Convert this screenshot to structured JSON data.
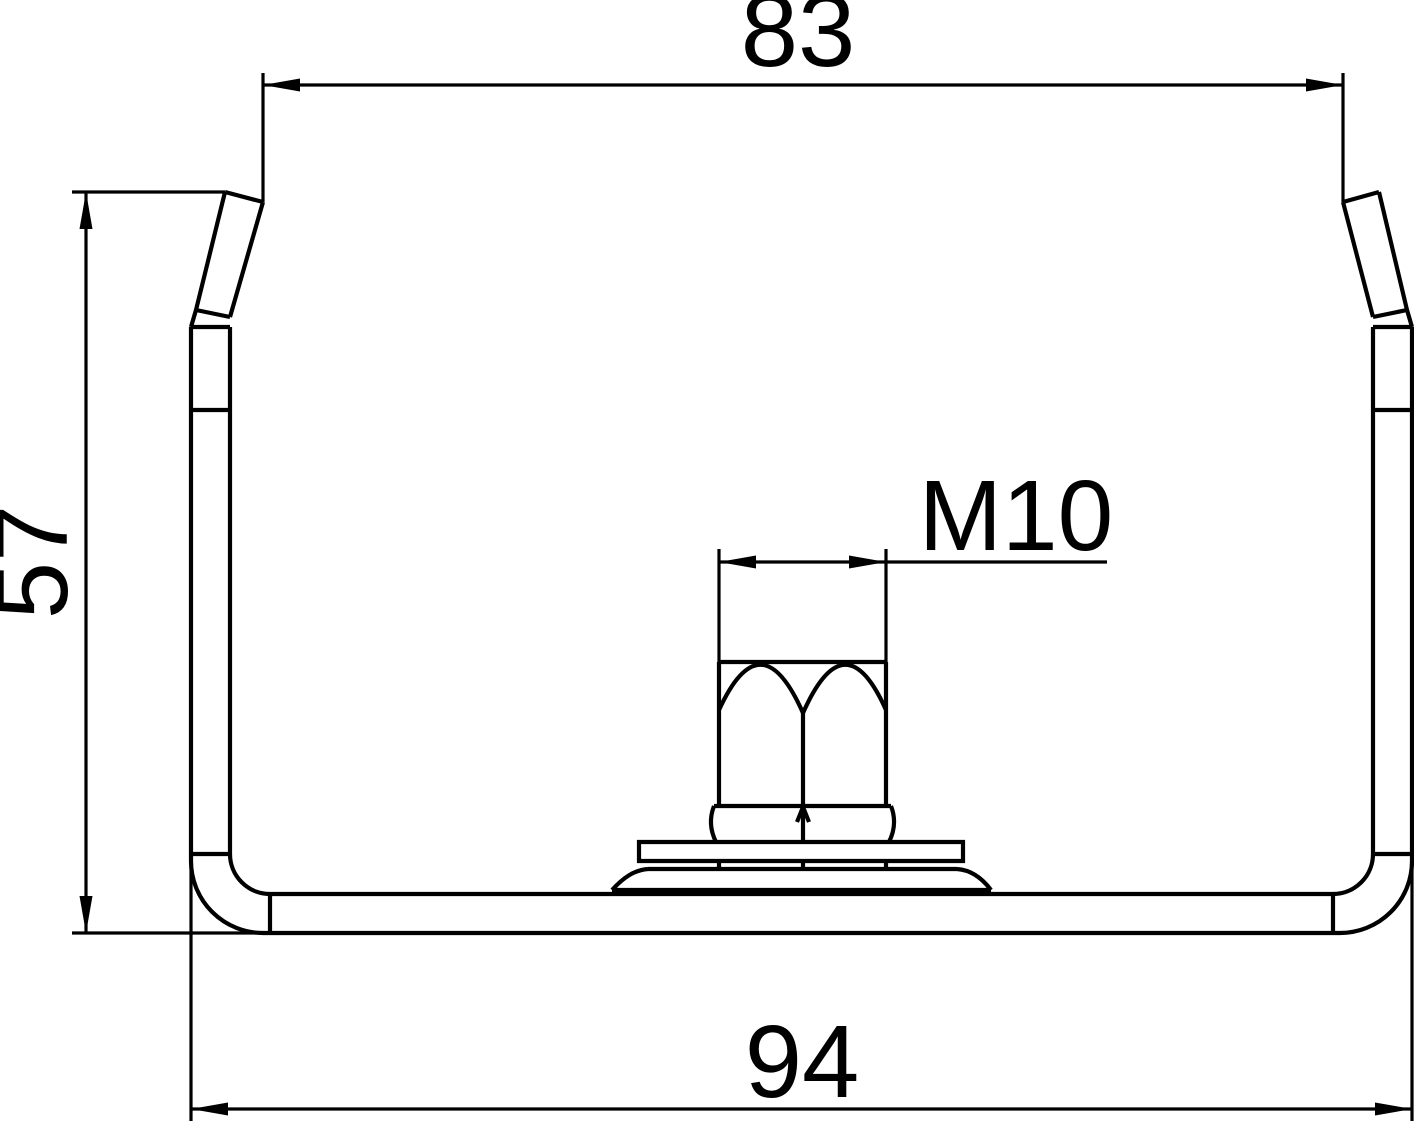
{
  "drawing": {
    "background_color": "#ffffff",
    "line_color": "#000000",
    "type": "technical-cross-section",
    "labels": {
      "width_top": "83",
      "height_left": "57",
      "width_bottom": "94",
      "thread": "M10"
    }
  }
}
